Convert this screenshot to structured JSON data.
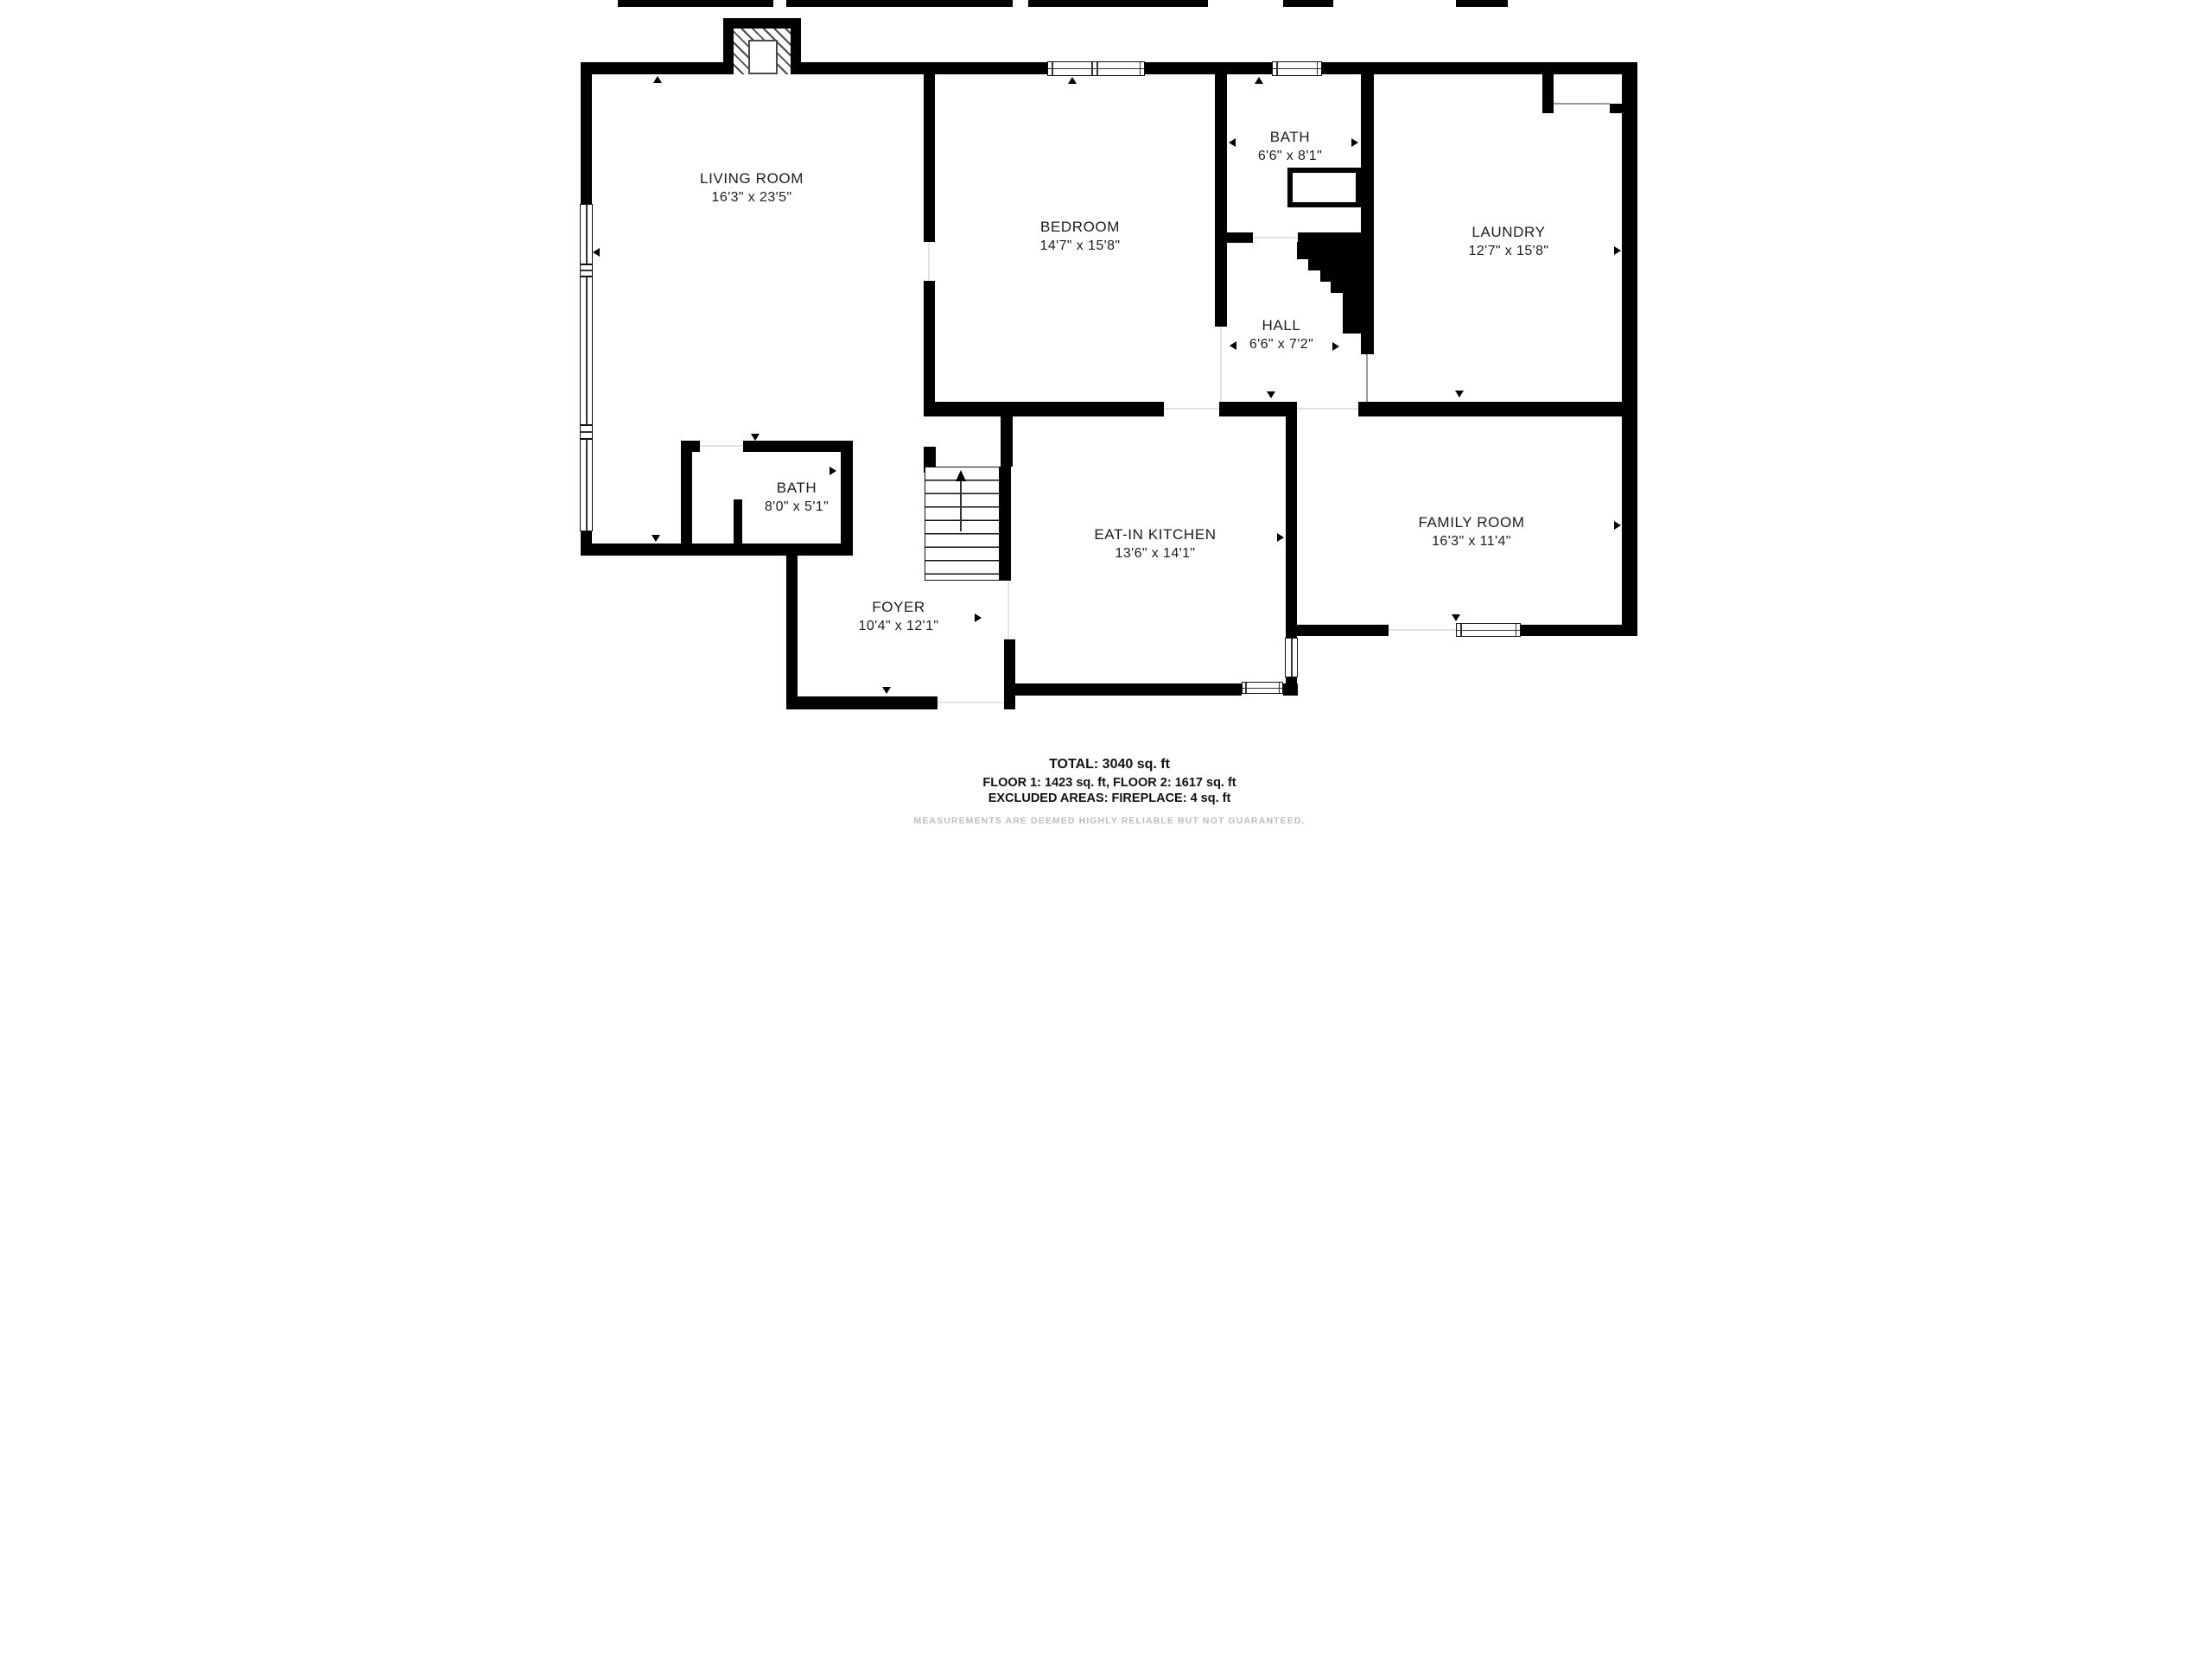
{
  "plan_title": "First floor plan",
  "rooms": [
    {
      "name": "LIVING ROOM",
      "dims": "16'3\" x 23'5\""
    },
    {
      "name": "BEDROOM",
      "dims": "14'7\" x 15'8\""
    },
    {
      "name": "BATH",
      "dims": "6'6\" x 8'1\""
    },
    {
      "name": "LAUNDRY",
      "dims": "12'7\" x 15'8\""
    },
    {
      "name": "HALL",
      "dims": "6'6\" x 7'2\""
    },
    {
      "name": "BATH",
      "dims": "8'0\" x 5'1\""
    },
    {
      "name": "FOYER",
      "dims": "10'4\" x 12'1\""
    },
    {
      "name": "EAT-IN KITCHEN",
      "dims": "13'6\" x 14'1\""
    },
    {
      "name": "FAMILY ROOM",
      "dims": "16'3\" x 11'4\""
    }
  ],
  "footer": {
    "total": "TOTAL: 3040 sq. ft",
    "floors": "FLOOR 1: 1423 sq. ft, FLOOR 2: 1617 sq. ft",
    "excluded": "EXCLUDED AREAS: FIREPLACE: 4 sq. ft",
    "disclaimer": "MEASUREMENTS ARE DEEMED HIGHLY RELIABLE BUT NOT GUARANTEED."
  },
  "colors": {
    "wall": "#000000",
    "opening_line": "#e2e2e2",
    "disclaimer_text": "#bdbdbd"
  }
}
